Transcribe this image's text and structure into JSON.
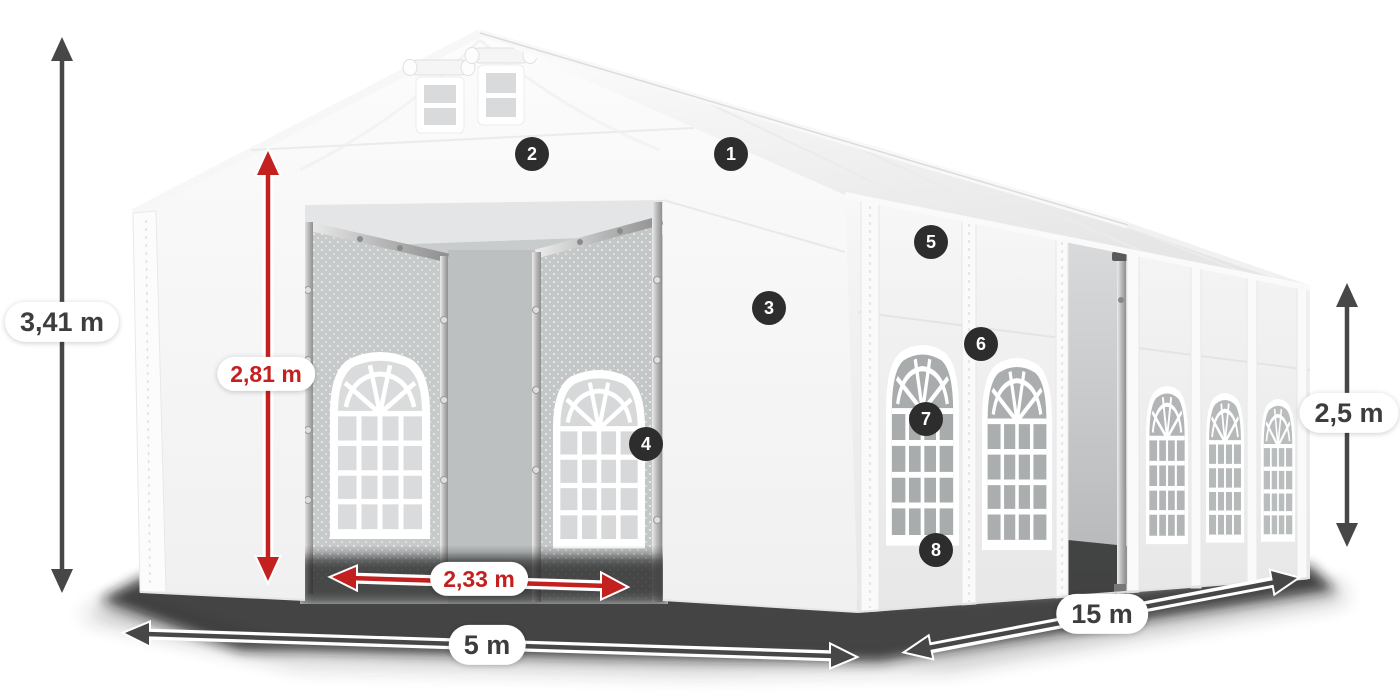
{
  "diagram": {
    "subject": "party-tent-dimensions",
    "measurements": [
      {
        "id": "total_height",
        "label": "3,41 m",
        "style": "dark",
        "icon": "double-arrow-vertical-icon"
      },
      {
        "id": "entrance_height",
        "label": "2,81 m",
        "style": "red",
        "icon": "double-arrow-vertical-icon"
      },
      {
        "id": "entrance_width",
        "label": "2,33 m",
        "style": "red",
        "icon": "double-arrow-horizontal-icon"
      },
      {
        "id": "front_width",
        "label": "5 m",
        "style": "dark",
        "icon": "double-arrow-horizontal-icon"
      },
      {
        "id": "length",
        "label": "15 m",
        "style": "dark",
        "icon": "double-arrow-diagonal-icon"
      },
      {
        "id": "side_height",
        "label": "2,5 m",
        "style": "dark",
        "icon": "double-arrow-vertical-icon"
      }
    ],
    "callouts": [
      {
        "number": "1"
      },
      {
        "number": "2"
      },
      {
        "number": "3"
      },
      {
        "number": "4"
      },
      {
        "number": "5"
      },
      {
        "number": "6"
      },
      {
        "number": "7"
      },
      {
        "number": "8"
      }
    ],
    "colors": {
      "measure_red": "#c32020",
      "measure_dark": "#474747",
      "badge_bg": "#2d2d2d",
      "badge_text": "#ffffff",
      "label_bg": "#ffffff",
      "label_text": "#3d3d3d",
      "tent_white": "#fafafa",
      "interior_gray": "#c9cccd"
    }
  }
}
